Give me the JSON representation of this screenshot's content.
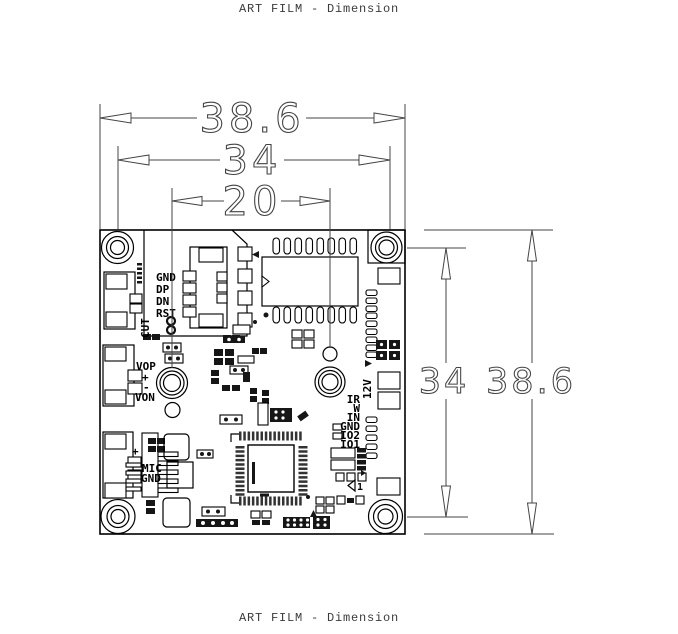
{
  "title_top": "ART FILM - Dimension",
  "title_bottom": "ART FILM - Dimension",
  "dims": {
    "board_width": "38.6",
    "hole_spacing_h": "34",
    "lens_spacing": "20",
    "hole_spacing_v": "34",
    "board_height": "38.6"
  },
  "silkscreen": {
    "usb_labels": [
      "GND",
      "DP",
      "DN",
      "RST"
    ],
    "cut_label": "CUT",
    "vop": "VOP",
    "plus": "+",
    "minus": "-",
    "von": "VON",
    "mic_plus": "+",
    "mic": "MIC",
    "mic_gnd": "GND",
    "power_12v": "12V",
    "io_labels": [
      "IR",
      "W",
      "IN",
      "GND",
      "IO2",
      "IO1"
    ],
    "pin1": "1"
  },
  "colors": {
    "line": "#000000",
    "dimension": "#444444",
    "silk": "#000000",
    "background": "#ffffff"
  }
}
